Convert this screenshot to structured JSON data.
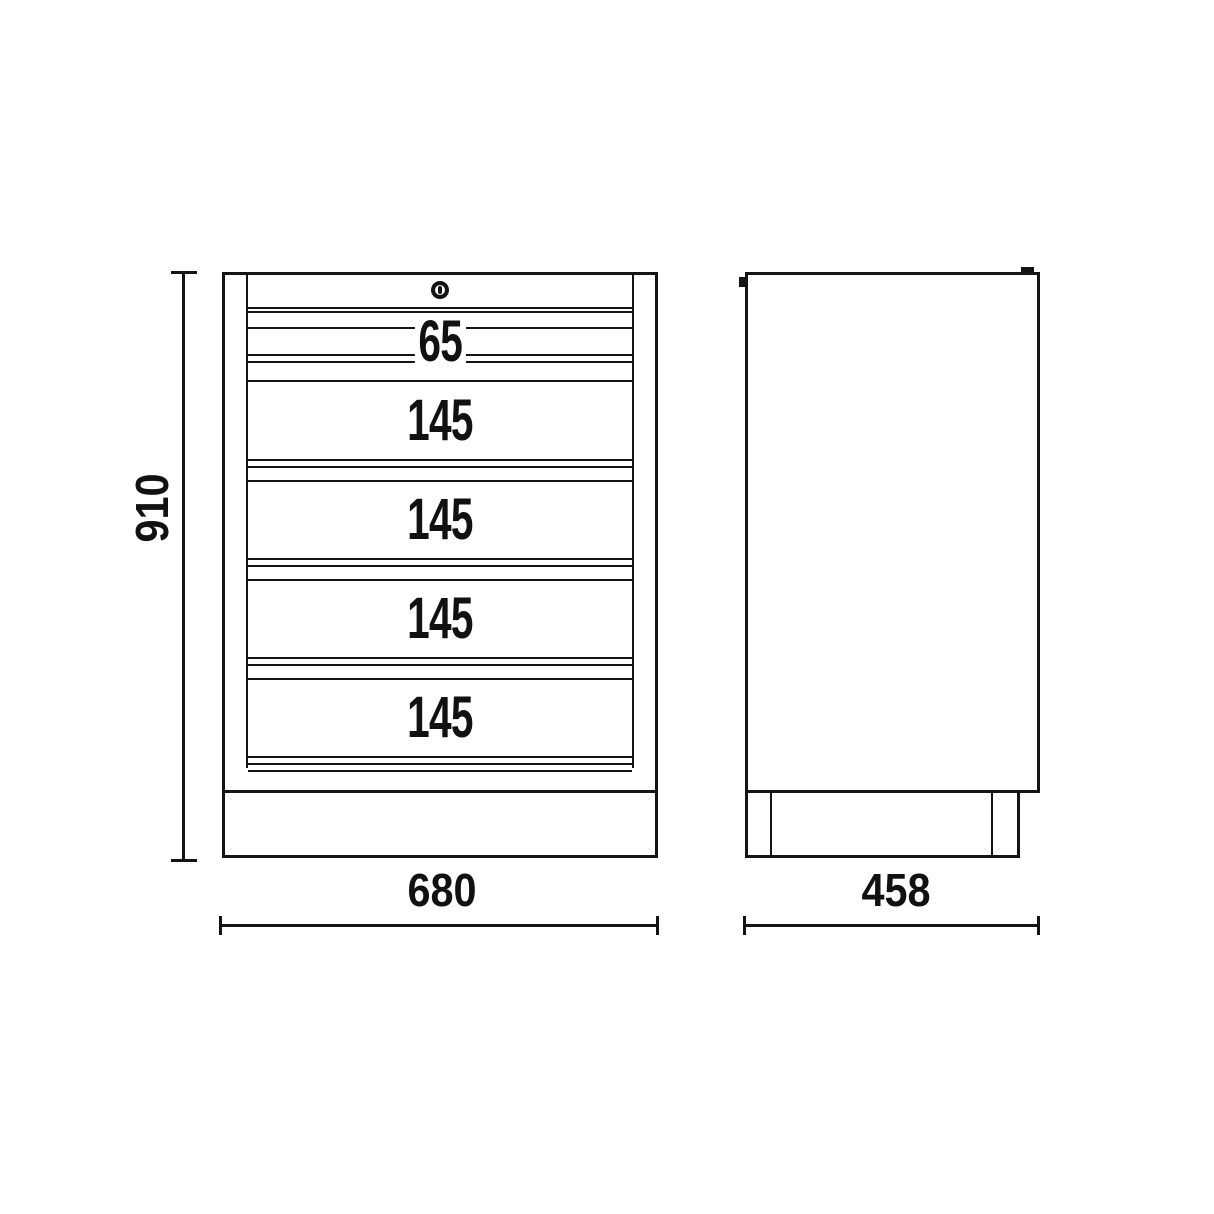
{
  "drawing": {
    "type": "technical-dimension-drawing",
    "subject": "drawer cabinet, front and side orthographic views",
    "front_view": {
      "lock_icon": "keyhole-icon",
      "drawer_labels": [
        "65",
        "145",
        "145",
        "145",
        "145"
      ],
      "height_dimension": "910",
      "width_dimension": "680"
    },
    "side_view": {
      "depth_dimension": "458"
    },
    "colors": {
      "line": "#141414",
      "background": "#ffffff"
    }
  }
}
